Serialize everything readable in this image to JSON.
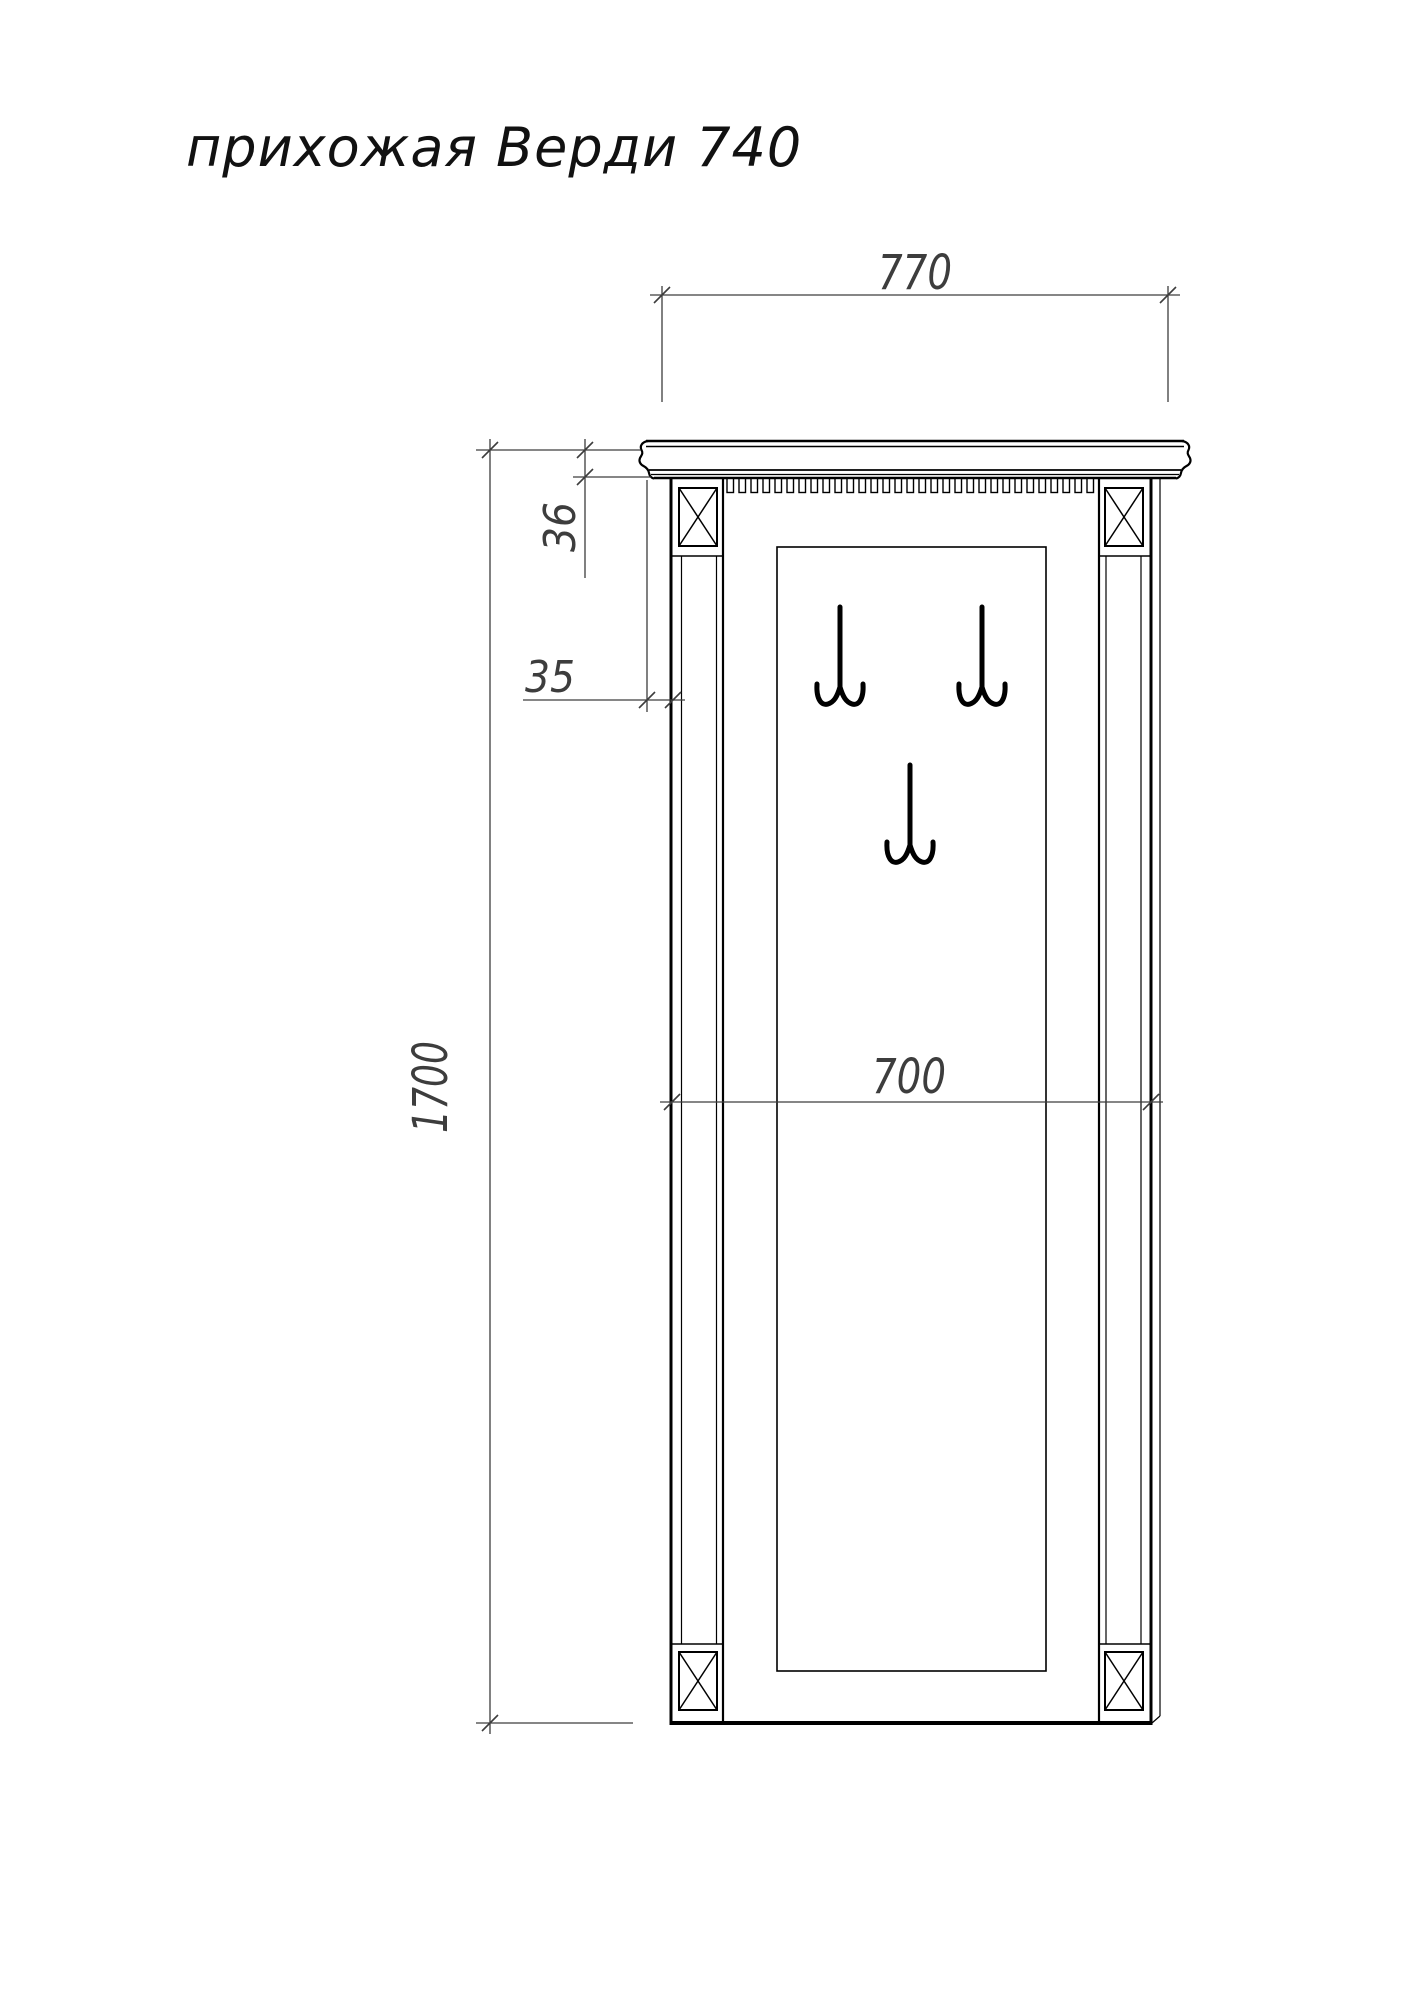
{
  "title": "прихожая Верди 740",
  "dimensions": {
    "overall_width": "770",
    "overall_height": "1700",
    "cornice_height": "36",
    "cornice_overhang": "35",
    "body_width": "700"
  },
  "colors": {
    "background": "#ffffff",
    "cabinet_line": "#000000",
    "dimension_line": "#3d3d3d"
  }
}
